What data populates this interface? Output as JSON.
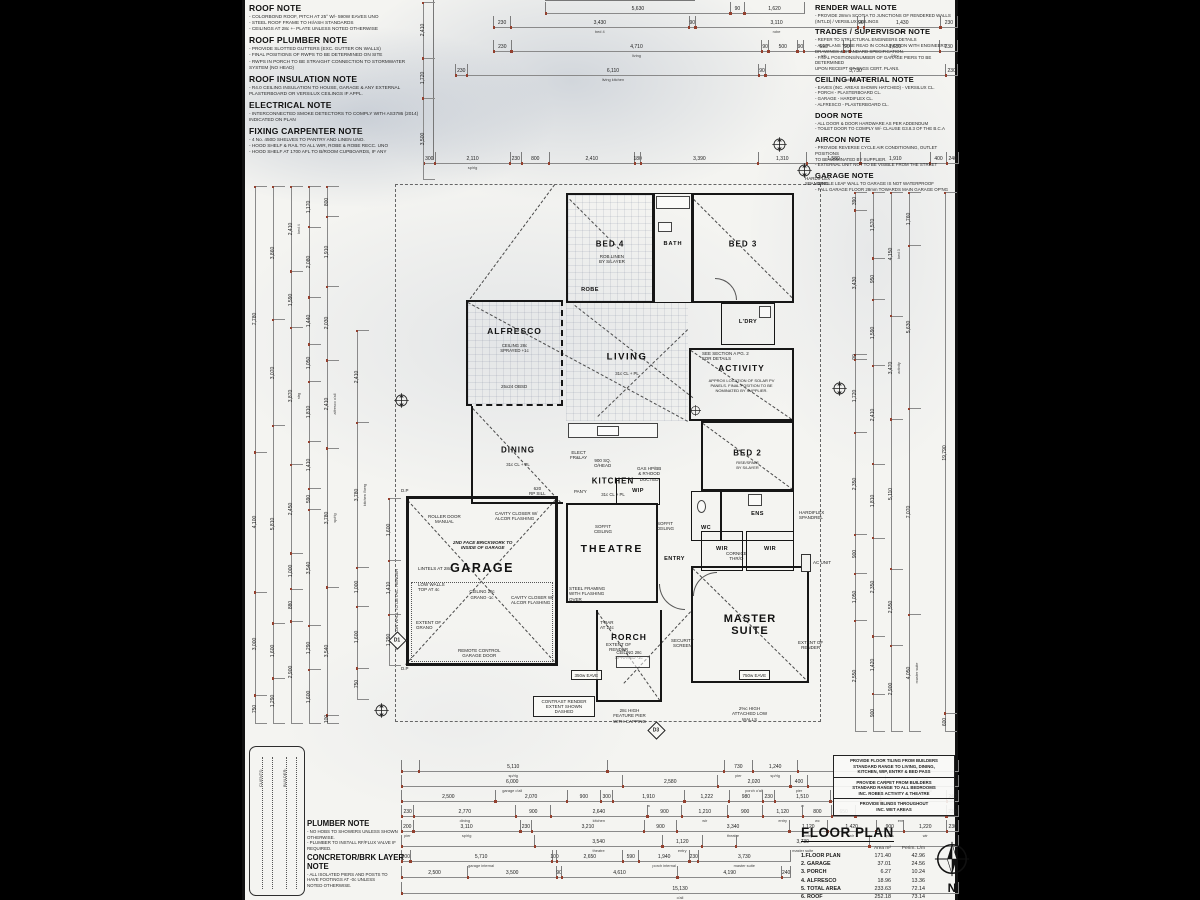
{
  "notes_left": [
    {
      "title": "ROOF NOTE",
      "body": "- COLORBOND ROOF, PITCH AT 25° W/- 590W EAVES UNO\n- STEEL ROOF FRAME TO HI/ASH STANDARDS\n- CEILINGS AT 28c +- PLATE UNLESS NOTED OTHERWISE"
    },
    {
      "title": "ROOF PLUMBER NOTE",
      "body": "- PROVIDE SLOTTED GUTTERS (EXC. GUTTER ON WALLS)\n- FINAL POSITIONS OF RWPS TO BE DETERMINED ON SITE\n- RWPS IN PORCH TO BE STRAIGHT CONNECTION TO STORMWATER\n  SYSTEM (NO HEAD)"
    },
    {
      "title": "ROOF INSULATION NOTE",
      "body": "- R4.0 CEILING INSULATION TO HOUSE, GARAGE & ANY EXTERNAL\n  PLASTERBOARD OR VERSILUX CEILINGS IF APPL."
    },
    {
      "title": "ELECTRICAL NOTE",
      "body": "- INTERCONNECTED SMOKE DETECTORS TO COMPLY WITH AS3786 (2014)\n  INDICATED ON PLAN"
    },
    {
      "title": "FIXING CARPENTER NOTE",
      "body": "- 4 No. 450D SHELVES TO PANTRY AND LINEN UNO.\n- HOOD SHELF & RAIL TO ALL WIR, ROBE & ROBE RECC. UNO\n- HOOD SHELF AT 1700 AFL TO B/ROOM CUPBOARDS, IF ANY"
    }
  ],
  "notes_right": [
    {
      "title": "RENDER WALL NOTE",
      "body": "- PROVIDE 28mm SCOTIA TO JUNCTIONS OF RENDERED WALLS\n  (INT.LD) / VERSILUX CEILINGS"
    },
    {
      "title": "TRADES / SUPERVISOR NOTE",
      "body": "- REFER TO STRUCTURAL ENGINEERS DETAILS\n- ALL PLANS TO BE READ IN CONJUNCTION WITH ENGINEERS\n  DRAWINGS & STANDARD SPECIFICATION.\n- FINAL POSITIONS/NUMBER OF GARAGE PIERS TO BE DETERMINED\n  UPON RECEIPT OF ENGS CERT. PLANS."
    },
    {
      "title": "CEILING MATERIAL NOTE",
      "body": "- EAVES (INC. AREAS SHOWN HATCHED) - VERSILUX CL.\n- PORCH - PLASTERBOARD CL.\n- GARAGE - HARDIFLEX CL.\n- ALFRESCO - PLASTERBOARD CL."
    },
    {
      "title": "DOOR NOTE",
      "body": "- ALL DOOR & DOOR HARDWARE AS PER ADDENDUM\n- TOILET DOOR TO COMPLY W/- CLAUSE G3.8.3 OF THE B.C.A"
    },
    {
      "title": "AIRCON NOTE",
      "body": "- PROVIDE REVERSE CYCLE AIR CONDITIONING, OUTLET POSITIONS\n  TO BE NOMINATED BY SUPPLIER.\n- EXTERNAL UNIT NOT TO BE VISIBLE FROM THE STREET"
    },
    {
      "title": "GARAGE NOTE",
      "body": "- SINGLE LEAF WALL TO GARAGE IS NOT WATERPROOF\n- FALL GARAGE FLOOR 28mm TOWARDS MAIN GARAGE OP'NG"
    }
  ],
  "rooms": {
    "bed4": {
      "name": "BED 4"
    },
    "bath": {
      "name": "BATH"
    },
    "bed3": {
      "name": "BED 3"
    },
    "ldry": {
      "name": "L'DRY"
    },
    "robe": {
      "name": "ROBE"
    },
    "alfresco": {
      "name": "ALFRESCO",
      "sub": "CEILING 28c\nSPRAYED +1c"
    },
    "living": {
      "name": "LIVING",
      "sub": "31c CL + PL"
    },
    "activity": {
      "name": "ACTIVITY",
      "sub": "APPROX LOCATION OF SOLAR PV\nPANELS. FINAL POSITION TO BE\nNOMINATED BY SUPPLIER."
    },
    "dining": {
      "name": "DINING",
      "sub": "31c CL + PL"
    },
    "kitchen": {
      "name": "KITCHEN",
      "sub": "31c CL + PL"
    },
    "bed2": {
      "name": "BED 2",
      "sub": "RISE/SPALS\nBY S/LAYER"
    },
    "wip": {
      "name": "WIP"
    },
    "wc": {
      "name": "WC"
    },
    "ens": {
      "name": "ENS"
    },
    "wir1": {
      "name": "WIR"
    },
    "wir2": {
      "name": "WIR"
    },
    "theatre": {
      "name": "THEATRE"
    },
    "entry": {
      "name": "ENTRY"
    },
    "garage": {
      "name": "GARAGE",
      "sub": "CEILING 28c\nGRANO -1c"
    },
    "master": {
      "name": "MASTER\nSUITE"
    },
    "porch": {
      "name": "PORCH",
      "sub": "CEILING 28c\nSPRAYED -1c"
    }
  },
  "ann": {
    "roller": "ROLLER DOOR\nMANUAL",
    "brick": "2ND FACE BRICKWORK TO\nINSIDE OF GARAGE",
    "lintels": "LINTELS AT 28c",
    "lowwalls": "LOW WALLS\nTOP AT 4c",
    "extgrano": "EXTENT OF\nGRANO",
    "remote": "REMOTE CONTROL\nGARAGE DOOR",
    "cavity": "CAVITY CLOSER W/\nALCOR FLASHING",
    "steel": "STEEL FRAMING\nWITH FLASHING\nOVER",
    "soffit": "SOFFIT\nCEILING",
    "cornice": "CORNICE\nTHR/O",
    "seesec": "SEE SECTION A PG. 2\nFOR DETAILS",
    "tbar": "T-BAR\nAT 24c",
    "extrender": "EXTENT OF\nRENDER",
    "security": "SECURITY\nSCREEN",
    "pier": "28c HIGH\nFEATURE PIER\nWITH CAPPING",
    "lowatt": "2%c HIGH\nATTACHED LOW\nWALLS",
    "hardiflex": "HARDIFLEX\nSPANDREL",
    "acunit": "AC UNIT",
    "eave350": "350w EAVE",
    "eave750": "750w EAVE",
    "robelinen": "ROB.LINEN\nBY S/LAYER",
    "obsd": "25x24 OBSD",
    "elect": "ELECT\nFR&LAY",
    "ohead": "900 SQ.\nO/HEAD",
    "gas": "GAS HP/BB\n& R'HOOD\nDUCTED",
    "pany": "PAN'Y",
    "rpsill": "620\nRP SILL",
    "dp": "D.P",
    "gutterwall": "GUTTER ON WALL TO DETAIL. RENDER",
    "contrast": "CONTRAST RENDER\nEXTENT SHOWN\nDASHED"
  },
  "markers": {
    "d1": "D1",
    "d3": "D3"
  },
  "compass": {
    "label": "N"
  },
  "provide_notes": [
    "PROVIDE FLOOR TILING FROM BUILDERS\nSTANDARD RANGE TO LIVING, DINING,\nKITCHEN, WIP, ENTRY & BED PASS",
    "PROVIDE CARPET FROM BUILDERS\nSTANDARD RANGE TO ALL BEDROOMS\nINC. ROBES ACTIVITY & THEATRE",
    "PROVIDE BLINDS THROUGHOUT\nINC. WET AREAS"
  ],
  "plumber_note": {
    "title": "PLUMBER NOTE",
    "body": "- NO HOBS TO SHOWERS UNLESS SHOWN\n  OTHERWISE.\n- PLUMBER TO INSTALL RF/FLUX VALVE IF\n  REQUIRED."
  },
  "concretor_note": {
    "title": "CONCRETOR/BRK LAYER\nNOTE",
    "body": "- ALL ISOLATED PIERS AND POSTS TO\n  HAVE FOOTINGS AT -0c UNLESS\n  NOTED OTHERWISE."
  },
  "sig": {
    "clients": "CLIENTS:",
    "builder": "BUILDER:"
  },
  "floor_plan": {
    "title": "FLOOR PLAN",
    "col_area": "Area m²",
    "col_perim": "Perim. L/m",
    "rows": [
      {
        "label": "1.FLOOR PLAN",
        "area": "171.40",
        "perim": "42.96"
      },
      {
        "label": "2. GARAGE",
        "area": "37.01",
        "perim": "24.56"
      },
      {
        "label": "3. PORCH",
        "area": "6.27",
        "perim": "10.24"
      },
      {
        "label": "4. ALFRESCO",
        "area": "18.96",
        "perim": "13.36"
      },
      {
        "label": "5. TOTAL AREA",
        "area": "233.63",
        "perim": "72.14"
      },
      {
        "label": "6. ROOF",
        "area": "252.18",
        "perim": "73.14"
      }
    ]
  },
  "dims": {
    "top_rows": [
      [
        {
          "v": "5,630",
          "w": 56
        },
        {
          "v": "90",
          "w": 4
        },
        {
          "v": "1,620",
          "w": 18
        }
      ],
      [
        {
          "v": "230",
          "w": 3
        },
        {
          "v": "3,430",
          "w": 33,
          "l": "bed 4"
        },
        {
          "v": "90",
          "w": 1
        },
        {
          "v": "3,110",
          "w": 30,
          "l": "robe"
        },
        {
          "v": "90",
          "w": 1
        },
        {
          "v": "1,430",
          "w": 14,
          "l": "wc"
        },
        {
          "v": "230",
          "w": 3
        }
      ],
      [
        {
          "v": "230",
          "w": 3
        },
        {
          "v": "4,710",
          "w": 45,
          "l": "living"
        },
        {
          "v": "90",
          "w": 1
        },
        {
          "v": "500",
          "w": 5
        },
        {
          "v": "90",
          "w": 1
        },
        {
          "v": "690",
          "w": 7,
          "l": "pdr"
        },
        {
          "v": "90",
          "w": 1
        },
        {
          "v": "1,650",
          "w": 16,
          "l": "l'dry"
        },
        {
          "v": "230",
          "w": 3
        }
      ],
      [
        {
          "v": "230",
          "w": 2
        },
        {
          "v": "6,110",
          "w": 55,
          "l": "living kitchen"
        },
        {
          "v": "90",
          "w": 1
        },
        {
          "v": "3,730",
          "w": 34,
          "l": "activity bed 2"
        },
        {
          "v": "230",
          "w": 2
        }
      ],
      [
        {
          "v": "300",
          "w": 2
        },
        {
          "v": "2,110",
          "w": 14,
          "l": "sp/rlg"
        },
        {
          "v": "230",
          "w": 2
        },
        {
          "v": "800",
          "w": 5
        },
        {
          "v": "2,410",
          "w": 16
        },
        {
          "v": "180",
          "w": 1
        },
        {
          "v": "3,390",
          "w": 22
        },
        {
          "v": "1,310",
          "w": 9
        },
        {
          "v": "1,580",
          "w": 10
        },
        {
          "v": "1,910",
          "w": 13
        },
        {
          "v": "400",
          "w": 3
        },
        {
          "v": "240",
          "w": 2
        }
      ]
    ],
    "bottom_rows": [
      [
        {
          "v": "",
          "w": 3
        },
        {
          "v": "5,110",
          "w": 34,
          "l": "sp/rlg"
        },
        {
          "v": "",
          "w": 21
        },
        {
          "v": "730",
          "w": 5,
          "l": "pier"
        },
        {
          "v": "1,240",
          "w": 8,
          "l": "sp/rlg"
        },
        {
          "v": "",
          "w": 29
        }
      ],
      [
        {
          "v": "6,000",
          "w": 40,
          "l": "garage o'all"
        },
        {
          "v": "2,580",
          "w": 17
        },
        {
          "v": "2,020",
          "w": 13,
          "l": "porch o'all"
        },
        {
          "v": "400",
          "w": 3,
          "l": "pier"
        },
        {
          "v": "",
          "w": 14
        },
        {
          "v": "2,030",
          "w": 13,
          "l": "feature wall"
        }
      ],
      [
        {
          "v": "2,500",
          "w": 17
        },
        {
          "v": "2,070",
          "w": 13
        },
        {
          "v": "900",
          "w": 6
        },
        {
          "v": "300",
          "w": 2
        },
        {
          "v": "1,910",
          "w": 13,
          "l": "w"
        },
        {
          "v": "1,222",
          "w": 8
        },
        {
          "v": "980",
          "w": 6
        },
        {
          "v": "230",
          "w": 2
        },
        {
          "v": "1,510",
          "w": 10,
          "l": "w"
        },
        {
          "v": "",
          "w": 9
        },
        {
          "v": "1,750",
          "w": 12
        },
        {
          "v": "240",
          "w": 2
        }
      ],
      [
        {
          "v": "230",
          "w": 2
        },
        {
          "v": "2,770",
          "w": 18,
          "l": "dining"
        },
        {
          "v": "900",
          "w": 6
        },
        {
          "v": "2,640",
          "w": 17,
          "l": "kitchen"
        },
        {
          "v": "900",
          "w": 6
        },
        {
          "v": "1,210",
          "w": 8,
          "l": "wir"
        },
        {
          "v": "900",
          "w": 6
        },
        {
          "v": "1,120",
          "w": 7,
          "l": "entry"
        },
        {
          "v": "800",
          "w": 5,
          "l": "wc"
        },
        {
          "v": "650",
          "w": 4
        },
        {
          "v": "2,400",
          "w": 16,
          "l": "ens"
        },
        {
          "v": "230",
          "w": 2
        }
      ],
      [
        {
          "v": "200",
          "w": 2,
          "l": "pier"
        },
        {
          "v": "3,110",
          "w": 20,
          "l": "sp/rlg"
        },
        {
          "v": "230",
          "w": 2
        },
        {
          "v": "3,210",
          "w": 21
        },
        {
          "v": "900",
          "w": 6
        },
        {
          "v": "3,340",
          "w": 21,
          "l": "theatre"
        },
        {
          "v": "1,120",
          "w": 7,
          "l": "entry"
        },
        {
          "v": "1,420",
          "w": 9,
          "l": "wir"
        },
        {
          "v": "900",
          "w": 5,
          "l": "pass"
        },
        {
          "v": "1,220",
          "w": 8,
          "l": "wir"
        },
        {
          "v": "230",
          "w": 2
        }
      ],
      [
        {
          "v": "",
          "w": 24
        },
        {
          "v": "3,540",
          "w": 23,
          "l": "theatre"
        },
        {
          "v": "1,120",
          "w": 7,
          "l": "entry"
        },
        {
          "v": "",
          "w": 6
        },
        {
          "v": "3,730",
          "w": 24,
          "l": "master suite"
        },
        {
          "v": "",
          "w": 16
        }
      ],
      [
        {
          "v": "200",
          "w": 2
        },
        {
          "v": "5,710",
          "w": 37,
          "l": "garage internal"
        },
        {
          "v": "100",
          "w": 1
        },
        {
          "v": "2,650",
          "w": 17
        },
        {
          "v": "590",
          "w": 4
        },
        {
          "v": "1,940",
          "w": 13,
          "l": "porch internal"
        },
        {
          "v": "230",
          "w": 2
        },
        {
          "v": "3,730",
          "w": 24,
          "l": "master suite"
        }
      ],
      [
        {
          "v": "2,500",
          "w": 17
        },
        {
          "v": "3,500",
          "w": 23
        },
        {
          "v": "90",
          "w": 1
        },
        {
          "v": "4,610",
          "w": 30
        },
        {
          "v": "4,190",
          "w": 27
        },
        {
          "v": "240",
          "w": 2
        }
      ],
      [
        {
          "v": "15,130",
          "w": 100,
          "l": "o'all"
        }
      ]
    ],
    "left_cols": [
      [
        {
          "v": "2,410",
          "w": 24
        },
        {
          "v": "1,720",
          "w": 17
        },
        {
          "v": "3,500",
          "w": 35
        }
      ],
      [
        {
          "v": "7,780",
          "w": 78
        },
        {
          "v": "4,100",
          "w": 41
        },
        {
          "v": "3,000",
          "w": 30
        },
        {
          "v": "750",
          "w": 8
        }
      ],
      [
        {
          "v": "3,860",
          "w": 39
        },
        {
          "v": "3,070",
          "w": 31
        },
        {
          "v": "5,810",
          "w": 58
        },
        {
          "v": "1,600",
          "w": 16
        },
        {
          "v": "1,290",
          "w": 13
        }
      ],
      [
        {
          "v": "2,410",
          "w": 24,
          "l": "bed 4"
        },
        {
          "v": "1,590",
          "w": 16
        },
        {
          "v": "3,870",
          "w": 39,
          "l": "strg"
        },
        {
          "v": "2,450",
          "w": 25
        },
        {
          "v": "1,000",
          "w": 10
        },
        {
          "v": "880",
          "w": 9
        },
        {
          "v": "2,900",
          "w": 29
        }
      ],
      [
        {
          "v": "1,170",
          "w": 12
        },
        {
          "v": "2,080",
          "w": 21
        },
        {
          "v": "1,440",
          "w": 14
        },
        {
          "v": "1,050",
          "w": 11
        },
        {
          "v": "1,810",
          "w": 18
        },
        {
          "v": "1,410",
          "w": 14
        },
        {
          "v": "590",
          "w": 6
        },
        {
          "v": "3,540",
          "w": 35
        },
        {
          "v": "1,290",
          "w": 13
        },
        {
          "v": "1,600",
          "w": 16
        }
      ],
      [
        {
          "v": "800",
          "w": 8
        },
        {
          "v": "1,910",
          "w": 19
        },
        {
          "v": "2,030",
          "w": 20
        },
        {
          "v": "2,410",
          "w": 24,
          "l": "alfresco o'all"
        },
        {
          "v": "3,780",
          "w": 38,
          "l": "sp/rlg"
        },
        {
          "v": "3,540",
          "w": 35
        },
        {
          "v": "100",
          "w": 2
        }
      ],
      [
        {
          "v": "2,410",
          "w": 24
        },
        {
          "v": "3,780",
          "w": 38,
          "l": "kitchen l'berg"
        },
        {
          "v": "1,000",
          "w": 10
        },
        {
          "v": "1,600",
          "w": 16
        },
        {
          "v": "750",
          "w": 8
        }
      ],
      [
        {
          "v": "1,600",
          "w": 16
        },
        {
          "v": "1,410",
          "w": 14
        },
        {
          "v": "1,290",
          "w": 13
        }
      ]
    ],
    "right_cols": [
      [
        {
          "v": "390",
          "w": 4
        },
        {
          "v": "3,430",
          "w": 34
        },
        {
          "v": "90",
          "w": 1
        },
        {
          "v": "1,720",
          "w": 17
        },
        {
          "v": "2,350",
          "w": 24
        },
        {
          "v": "900",
          "w": 9
        },
        {
          "v": "1,050",
          "w": 11
        },
        {
          "v": "2,550",
          "w": 26
        }
      ],
      [
        {
          "v": "1,570",
          "w": 16
        },
        {
          "v": "950",
          "w": 10
        },
        {
          "v": "1,590",
          "w": 16
        },
        {
          "v": "2,410",
          "w": 24
        },
        {
          "v": "1,810",
          "w": 18
        },
        {
          "v": "2,350",
          "w": 24
        },
        {
          "v": "1,420",
          "w": 14
        },
        {
          "v": "900",
          "w": 9
        }
      ],
      [
        {
          "v": "4,150",
          "w": 42,
          "l": "bed 3"
        },
        {
          "v": "3,470",
          "w": 35,
          "l": "activity"
        },
        {
          "v": "5,110",
          "w": 51
        },
        {
          "v": "2,550",
          "w": 26
        },
        {
          "v": "2,900",
          "w": 29
        }
      ],
      [
        {
          "v": "1,760",
          "w": 18
        },
        {
          "v": "5,630",
          "w": 56
        },
        {
          "v": "7,070",
          "w": 71
        },
        {
          "v": "4,050",
          "w": 40,
          "l": "master suite"
        }
      ],
      [
        {
          "v": "19,790",
          "w": 180
        },
        {
          "v": "600",
          "w": 6
        }
      ]
    ]
  }
}
